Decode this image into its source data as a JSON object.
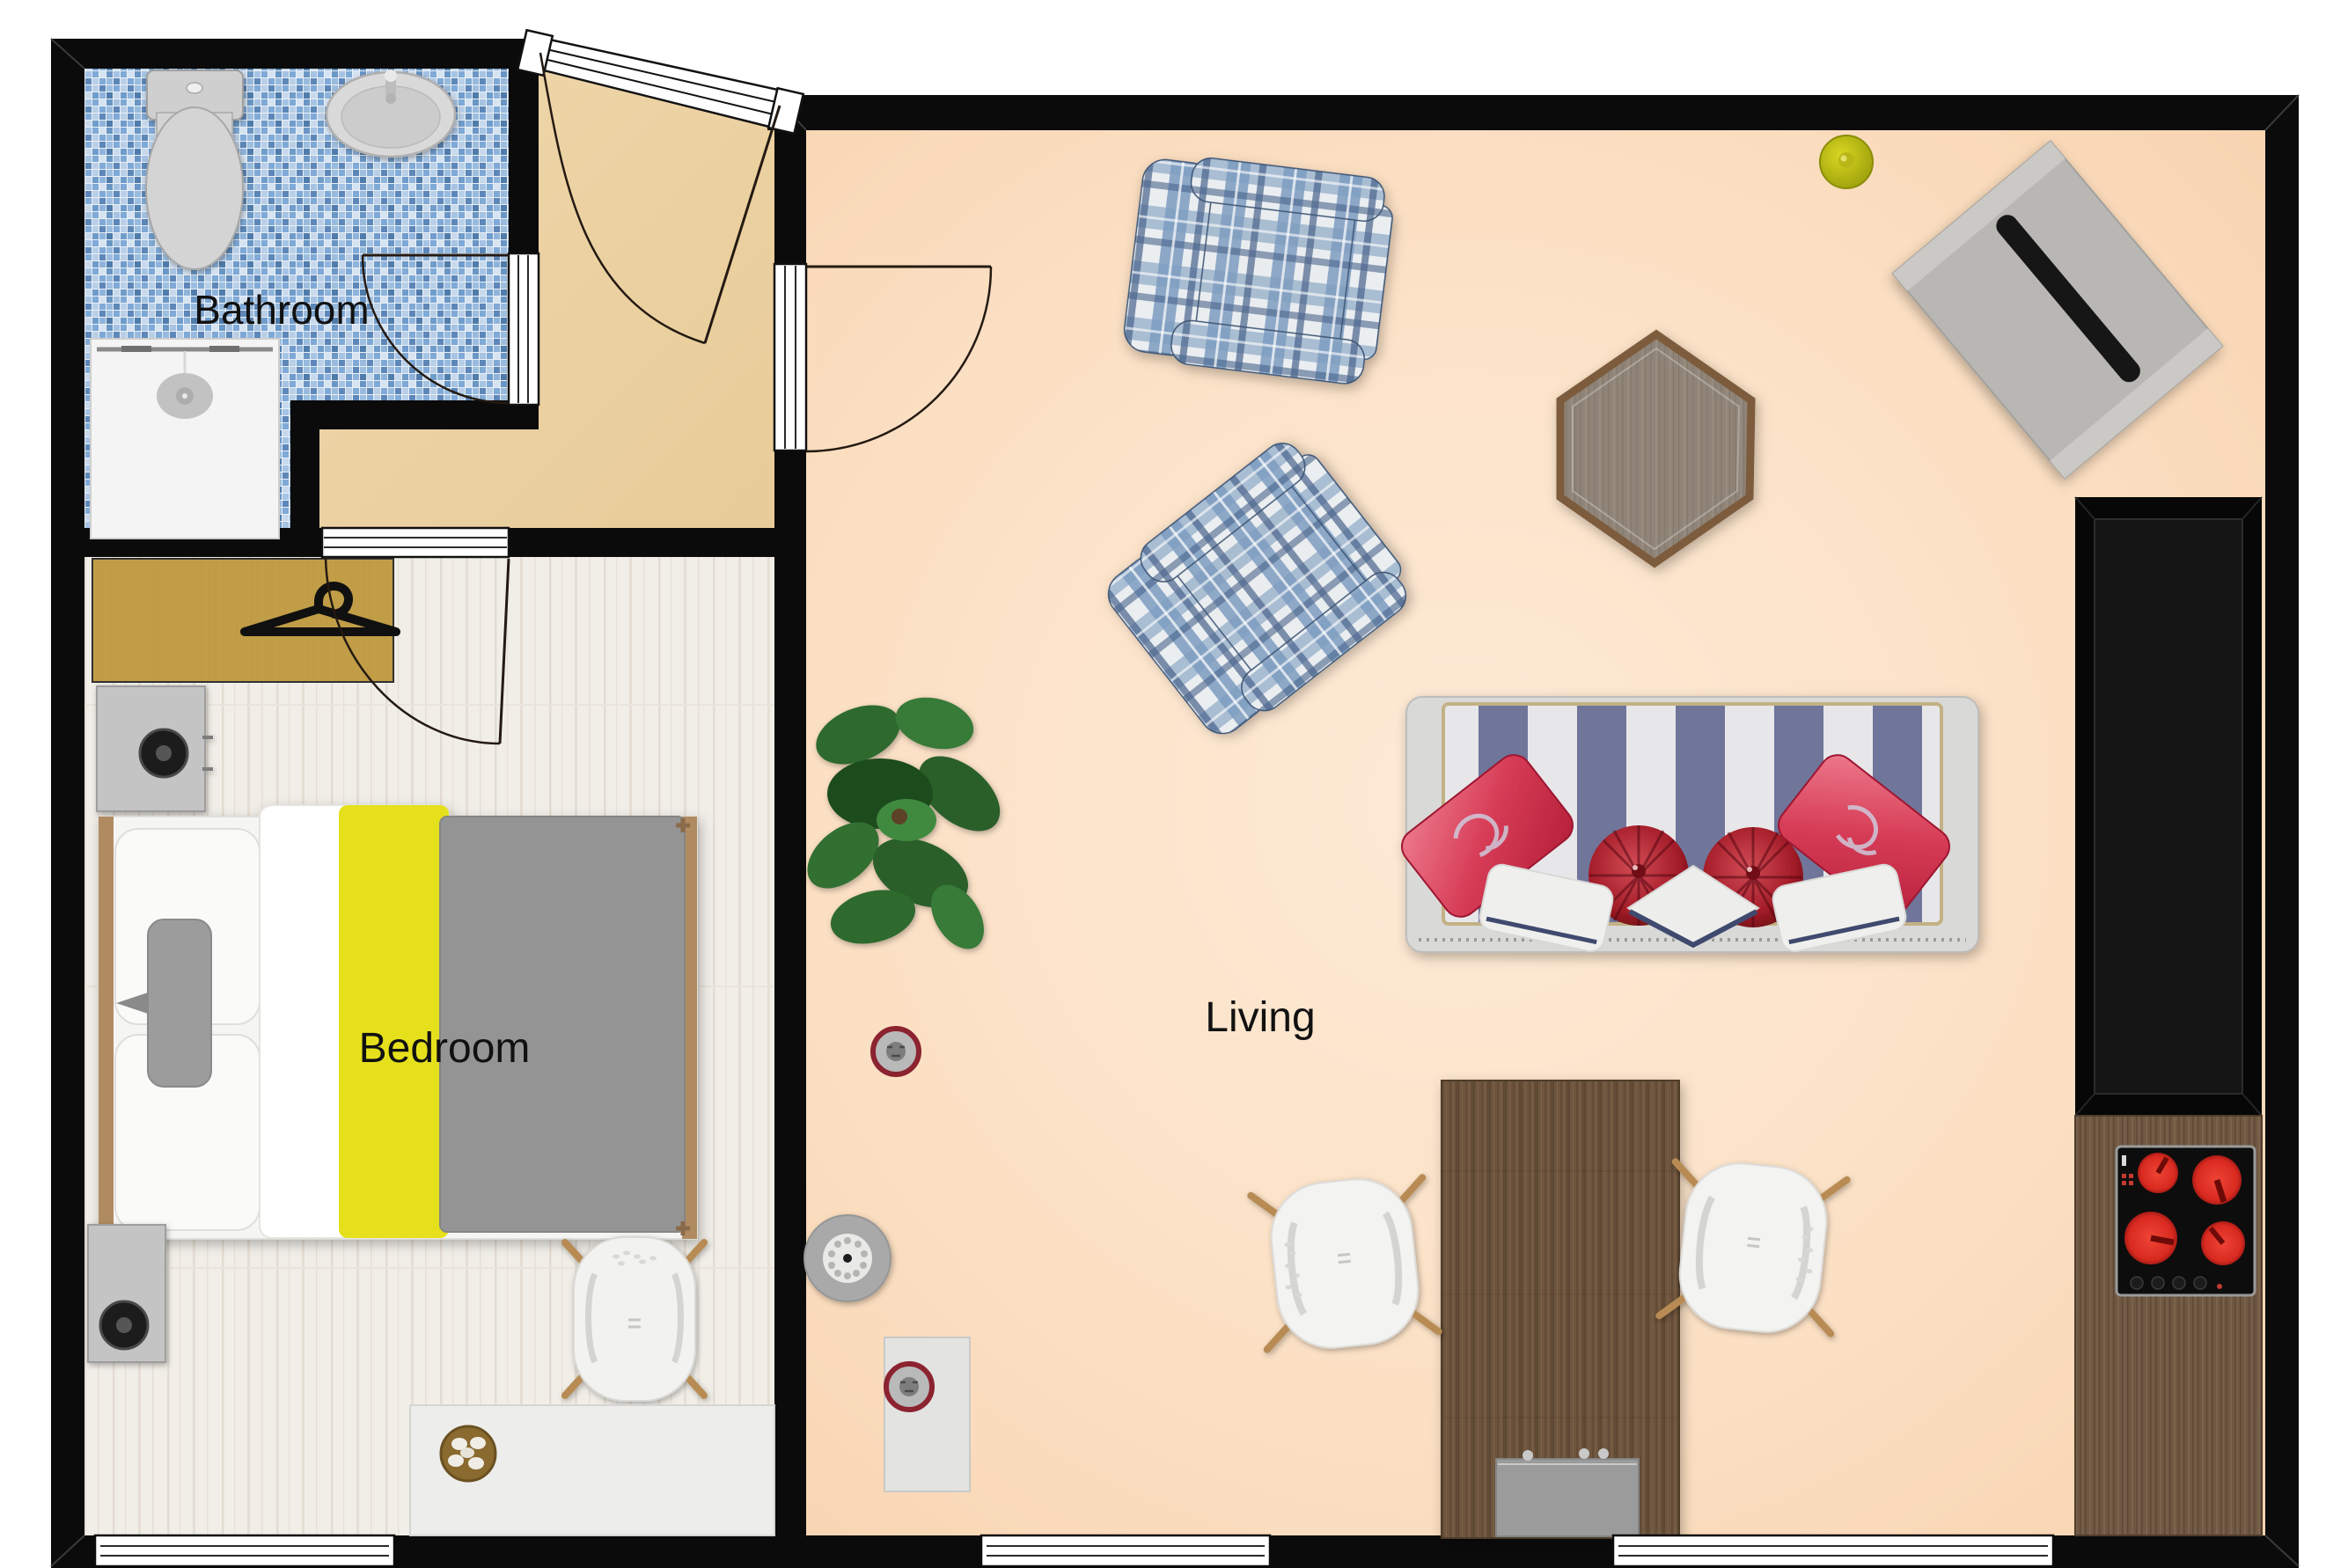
{
  "plan_title": "Studio apartment floor plan",
  "rooms": {
    "bathroom": {
      "label": "Bathroom",
      "floor_style": "blue mosaic tile",
      "floor_color": "#7fa9d6"
    },
    "hall": {
      "label": "",
      "floor_style": "tan",
      "floor_color": "#edd3a3"
    },
    "bedroom": {
      "label": "Bedroom",
      "floor_style": "whitewashed wood",
      "floor_color": "#f0ece4"
    },
    "living": {
      "label": "Living",
      "floor_style": "peach",
      "floor_color": "#fbdcbc"
    }
  },
  "furniture": {
    "bathroom": [
      "toilet",
      "sink",
      "shower"
    ],
    "bedroom": [
      "wardrobe with hanger",
      "dresser with speaker",
      "double bed",
      "nightstand with speaker",
      "side chair",
      "desk",
      "fruit bowl"
    ],
    "living": [
      "plaid armchair top",
      "plaid armchair bottom",
      "hexagon side table",
      "tv board",
      "striped sofa",
      "red throw pillows",
      "floor plant",
      "dining table",
      "dining chair left",
      "dining chair right",
      "sink cabinet",
      "tall black cabinet",
      "cooktop with 4 burners",
      "yellow ceiling lamp",
      "robot vacuum",
      "dock box",
      "smoke detector"
    ]
  },
  "colors": {
    "wall": "#0b0b0b",
    "bed_accent_yellow": "#e6e01e",
    "blanket_gray": "#949494",
    "plaid_blue": "#6f93b8",
    "sofa_stripe_blue": "#6f749b",
    "pillow_red": "#c32840",
    "burner_red": "#e03026",
    "table_wood": "#6b523c",
    "closet_wood": "#c7a03f",
    "lamp_yellow": "#c9c81d"
  }
}
